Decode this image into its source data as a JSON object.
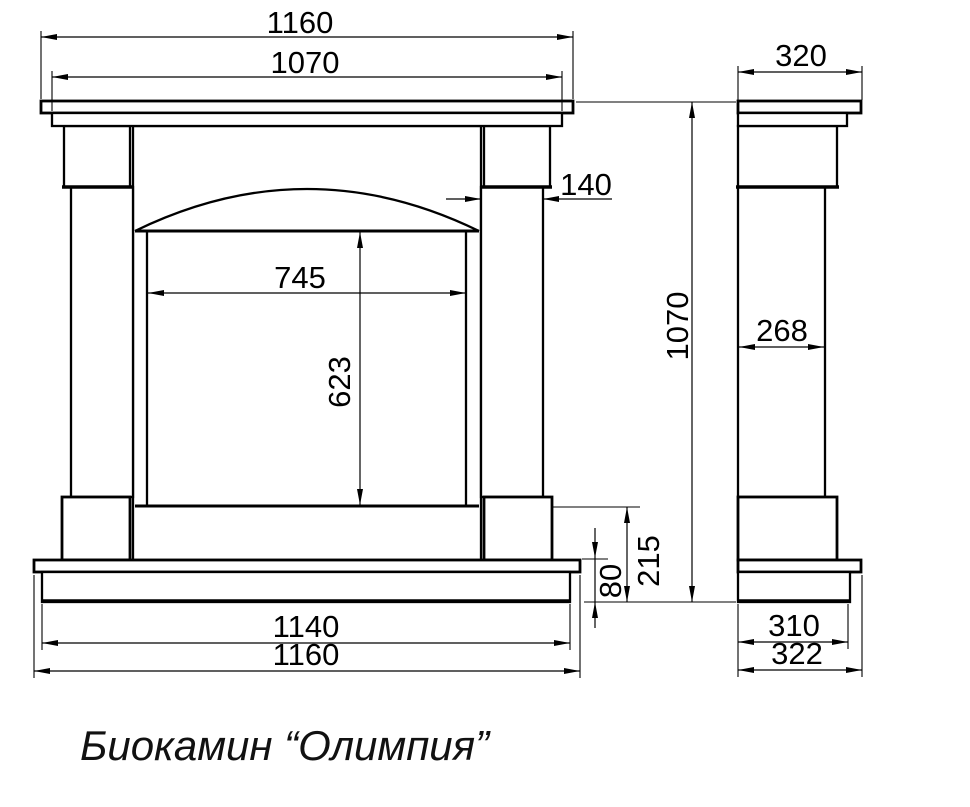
{
  "title": "Биокамин “Олимпия”",
  "colors": {
    "line": "#000000",
    "background": "#ffffff"
  },
  "front_view": {
    "dimensions": {
      "overall_width_top": "1160",
      "mantel_inner_width": "1070",
      "column_width": "140",
      "firebox_width": "745",
      "firebox_height": "623",
      "hearth_height": "215",
      "plinth_height": "80",
      "plinth_width": "1140",
      "overall_width_bottom": "1160"
    }
  },
  "side_view": {
    "dimensions": {
      "mantel_depth": "320",
      "overall_height": "1070",
      "column_depth": "268",
      "plinth_depth": "310",
      "base_depth": "322"
    }
  }
}
